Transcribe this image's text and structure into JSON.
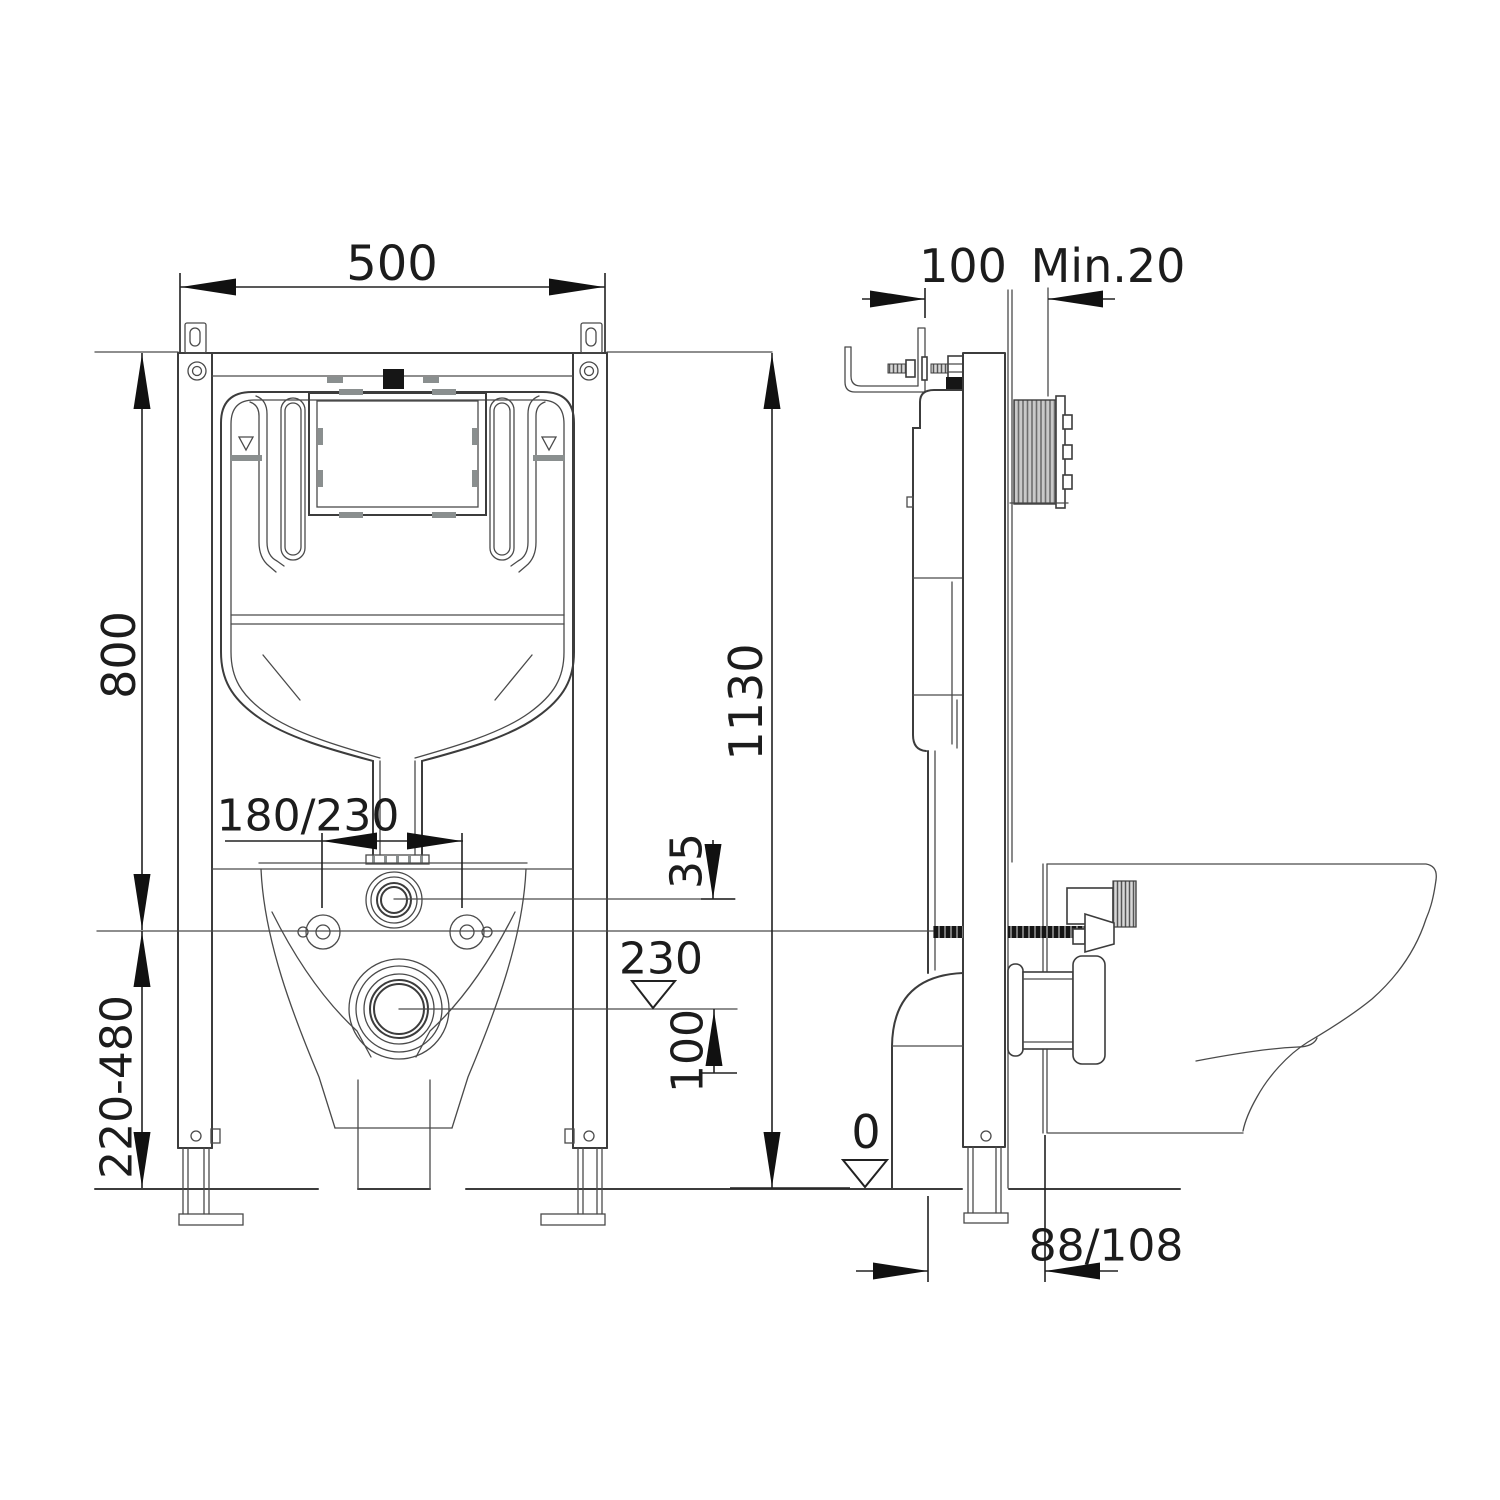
{
  "front": {
    "width": "500",
    "upper_height": "800",
    "adjust_range": "220-480",
    "total_height": "1130",
    "hole_spacing": "180/230",
    "offset": "35",
    "outlet_level": "230",
    "outlet_drop": "100"
  },
  "side": {
    "bracket_depth": "100",
    "min_wall": "Min.20",
    "floor_level": "0",
    "outlet_distance": "88/108"
  },
  "colors": {
    "line": "#3c3c3c",
    "dimension": "#222222",
    "grey_fill": "#8a8f8f",
    "dark_fill": "#161616",
    "background": "#ffffff"
  }
}
